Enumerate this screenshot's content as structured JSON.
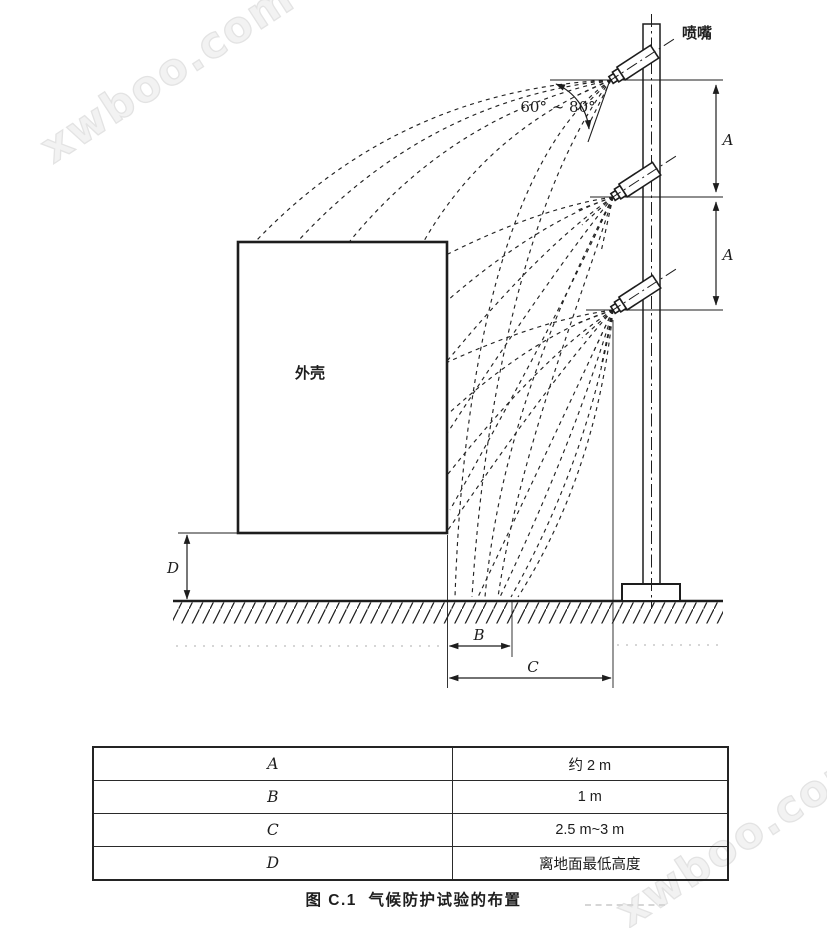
{
  "watermarks": {
    "top_left": "xwboo.com",
    "bottom_right": "xwboo.com"
  },
  "diagram": {
    "nozzle_label": "喷嘴",
    "enclosure_label": "外壳",
    "angle_label": "60° ~ 80°",
    "dims": {
      "a_upper": "A",
      "a_lower": "A",
      "b": "B",
      "c": "C",
      "d": "D"
    }
  },
  "table": {
    "rows": [
      {
        "param": "A",
        "value": "约 2 m"
      },
      {
        "param": "B",
        "value": "1 m"
      },
      {
        "param": "C",
        "value": "2.5 m~3 m"
      },
      {
        "param": "D",
        "value": "离地面最低高度"
      }
    ]
  },
  "caption": "图 C.1  气候防护试验的布置",
  "colors": {
    "ink": "#1d1d1d",
    "watermark": "#e3e3e3"
  }
}
